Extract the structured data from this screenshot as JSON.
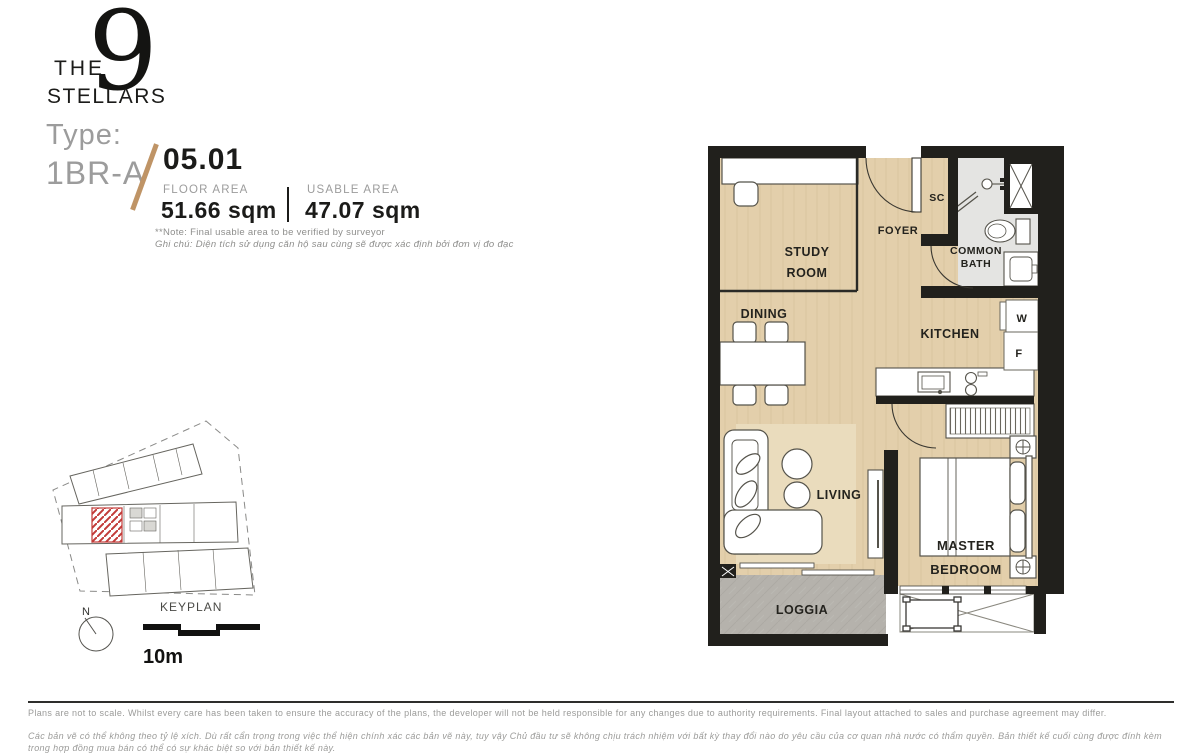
{
  "brand": {
    "the": "THE",
    "numeral": "9",
    "stellars": "STELLARS"
  },
  "unit": {
    "type_label": "Type:",
    "type_value": "1BR-A",
    "number": "05.01"
  },
  "areas": {
    "floor_label": "FLOOR AREA",
    "floor_value": "51.66 sqm",
    "usable_label": "USABLE AREA",
    "usable_value": "47.07 sqm"
  },
  "notes": {
    "en": "**Note: Final usable area to be verified by surveyor",
    "vi": "Ghi chú: Diện tích sử dụng căn hộ sau cùng sẽ được xác định bởi đơn vị đo đạc"
  },
  "floorplan": {
    "rooms": {
      "study1": "STUDY",
      "study2": "ROOM",
      "foyer": "FOYER",
      "sc": "SC",
      "bath1": "COMMON",
      "bath2": "BATH",
      "dining": "DINING",
      "kitchen": "KITCHEN",
      "washer": "W",
      "fridge": "F",
      "living": "LIVING",
      "master1": "MASTER",
      "master2": "BEDROOM",
      "loggia": "LOGGIA"
    }
  },
  "keyplan": {
    "title": "KEYPLAN",
    "north": "N",
    "scale": "10m"
  },
  "disclaimer": {
    "en": "Plans are not to scale. Whilst every care has been taken to ensure the accuracy of the plans, the developer will not be held responsible for any changes due to authority requirements. Final layout attached to sales and purchase agreement may differ.",
    "vi": "Các bản vẽ có thể không theo tỷ lệ xích. Dù rất cẩn trọng trong việc thể hiện chính xác các bản vẽ này, tuy vậy Chủ đầu tư sẽ không chịu trách nhiệm với bất kỳ thay đổi nào do yêu cầu của cơ quan nhà nước có thẩm quyền. Bản thiết kế cuối cùng được đính kèm trong hợp đồng mua bán có thể có sự khác biệt so với bản thiết kế này."
  },
  "colors": {
    "accent": "#bf9466",
    "wall": "#21201c",
    "floor": "#e3cfab",
    "bath_floor": "#e4e4e2",
    "loggia_floor": "#b5b2ac",
    "keyplan_unit": "#c23b38"
  }
}
